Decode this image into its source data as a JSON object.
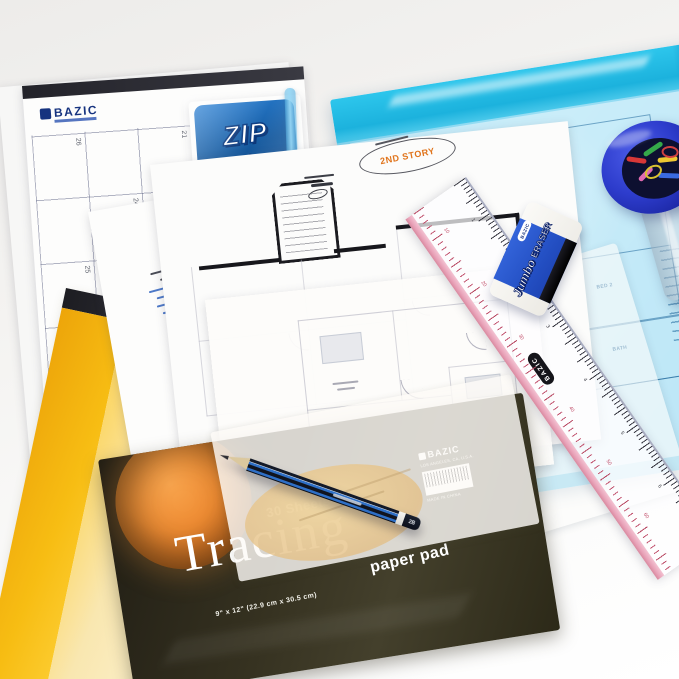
{
  "photo": {
    "background": "#f4f3f1",
    "caption": "Stationery flat-lay with drafting supplies"
  },
  "calendar_pad": {
    "brand": "BAZIC",
    "watermark": "BAZIC",
    "dates": [
      "26",
      "21",
      "10",
      "24",
      "25",
      "16",
      "8"
    ]
  },
  "zip_pack": {
    "title": "ZIP",
    "subtitle": "Envelope",
    "features": [
      "3 Pack Expansion",
      "Durable Material Protects Content",
      "Accommodates Letter Size Documents",
      "Zip Closure for Convenient Resealing"
    ],
    "brand": "BAZIC"
  },
  "blue_envelope": {
    "rooms": [
      "DINING",
      "LIVING",
      "BED 2",
      "BATH"
    ]
  },
  "floor_plan": {
    "stamp": "2ND STORY"
  },
  "eraser": {
    "brand": "BAZIC",
    "line1": "Jumbo",
    "line2": "ERASER"
  },
  "ruler": {
    "brand": "BAZIC",
    "cm_labels": [
      "10",
      "20",
      "30",
      "40",
      "50",
      "60"
    ],
    "inch_labels": [
      "1",
      "2",
      "3",
      "4",
      "5",
      "6"
    ]
  },
  "pencil": {
    "grade": "2B"
  },
  "tracing_pad": {
    "sheets": "30 Sheets",
    "title": "Tracing",
    "subtitle": "paper pad",
    "size": "9\" x 12\" (22.9 cm x 30.5 cm)",
    "brand": "BAZIC",
    "address": "LOS ANGELES, CA, U.S.A.",
    "origin": "MADE IN CHINA"
  }
}
